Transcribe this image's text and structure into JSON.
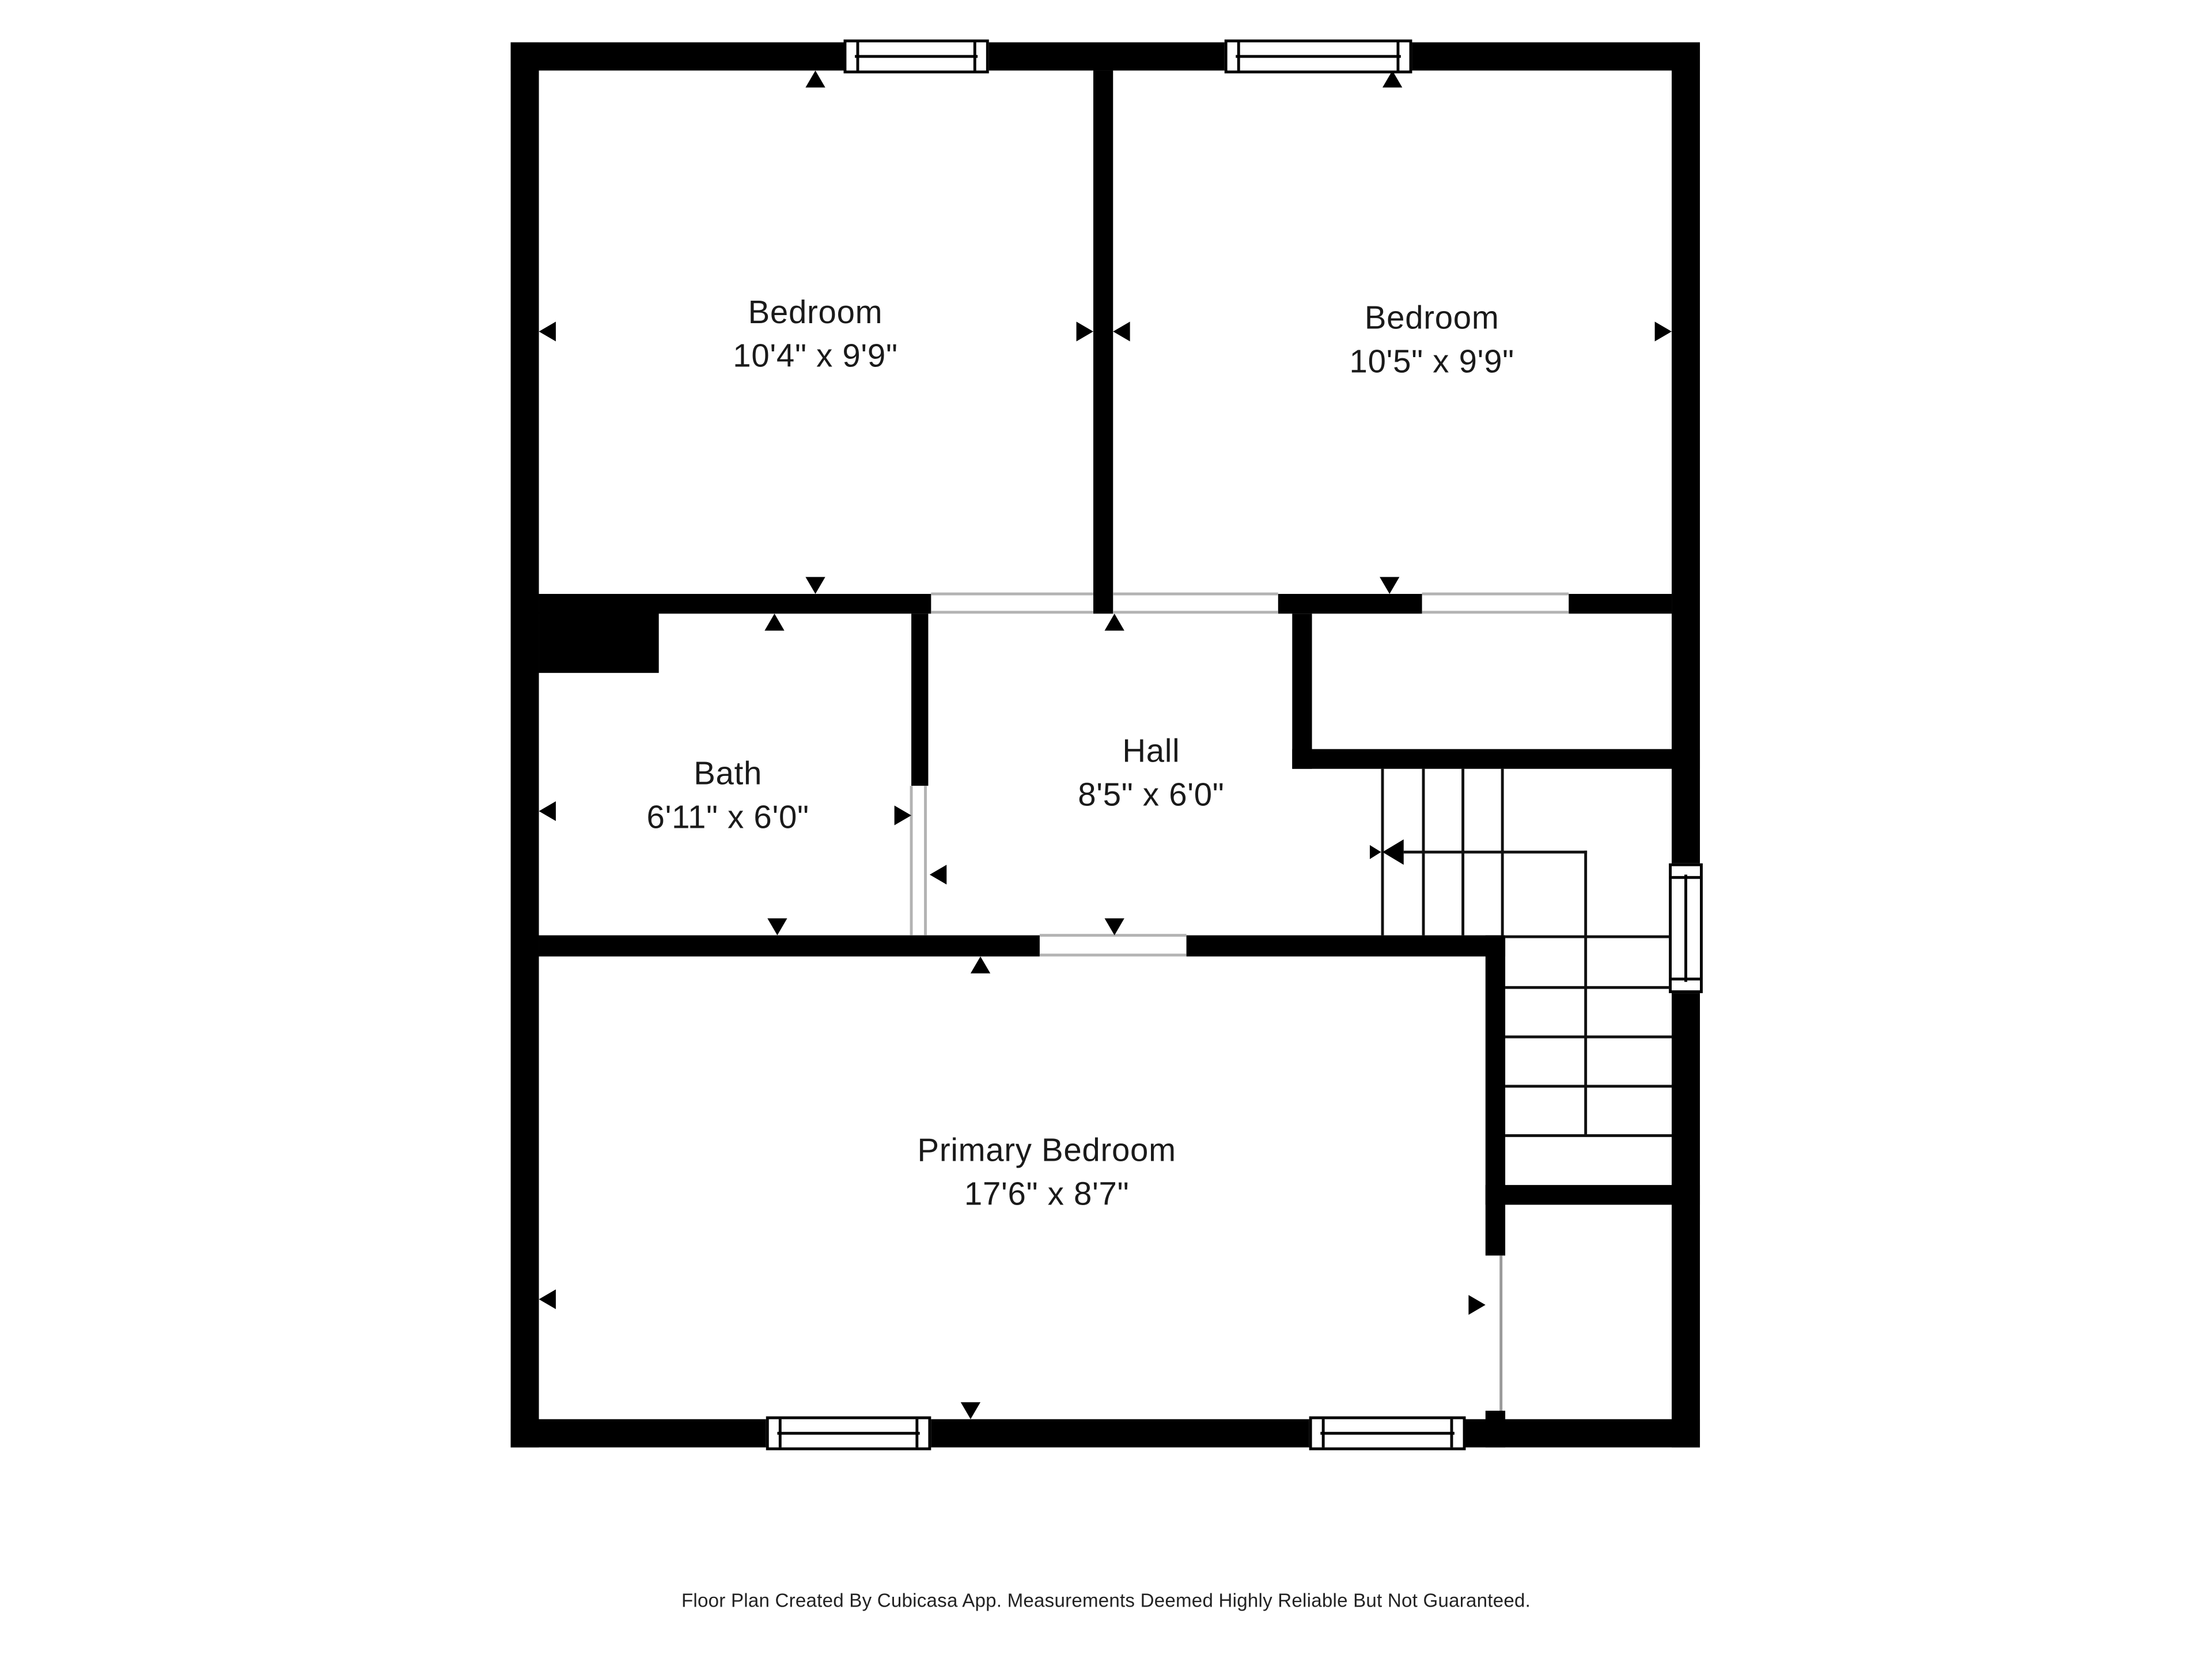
{
  "rooms": [
    {
      "id": "bedroom-1",
      "name": "Bedroom",
      "dimensions": "10'4\" x 9'9\""
    },
    {
      "id": "bedroom-2",
      "name": "Bedroom",
      "dimensions": "10'5\" x 9'9\""
    },
    {
      "id": "bath",
      "name": "Bath",
      "dimensions": "6'11\" x 6'0\""
    },
    {
      "id": "hall",
      "name": "Hall",
      "dimensions": "8'5\" x 6'0\""
    },
    {
      "id": "primary-bedroom",
      "name": "Primary Bedroom",
      "dimensions": "17'6\" x 8'7\""
    }
  ],
  "footer": {
    "disclaimer": "Floor Plan Created By Cubicasa App. Measurements Deemed Highly Reliable But Not Guaranteed."
  },
  "colors": {
    "wall": "#000000",
    "background": "#ffffff",
    "door_opening_line": "#b3b3b3",
    "text": "#1a1a1a"
  }
}
